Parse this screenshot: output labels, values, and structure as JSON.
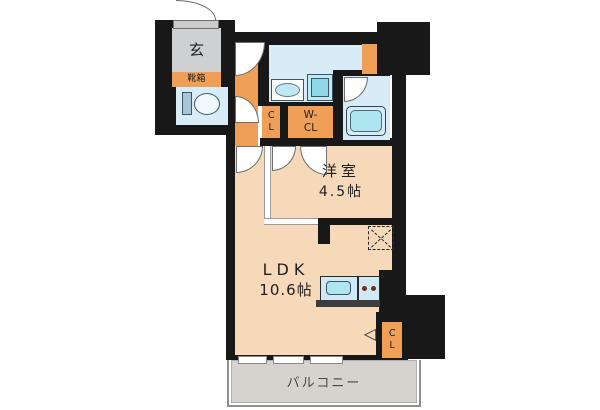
{
  "floorplan": {
    "entrance": {
      "label": "玄"
    },
    "shoe_box": {
      "label": "靴箱"
    },
    "hall_closet": {
      "label": "CL"
    },
    "walk_in_closet": {
      "label": "W-CL"
    },
    "western_room": {
      "name": "洋室",
      "size": "4.5帖"
    },
    "ldk": {
      "name": "LDK",
      "size": "10.6帖"
    },
    "living_closet": {
      "label": "CL"
    },
    "balcony": {
      "label": "バルコニー"
    },
    "icons": {
      "entry_arrow": "◁"
    },
    "colors": {
      "wall": "#181818",
      "hall_orange": "#ef9f56",
      "room_peach": "#f5d9b8",
      "wet_blue": "#d7ecf7",
      "fixture_cyan": "#aee6f0",
      "entrance_gray": "#ced0d2",
      "balcony_gray": "#d6d3cf"
    }
  }
}
